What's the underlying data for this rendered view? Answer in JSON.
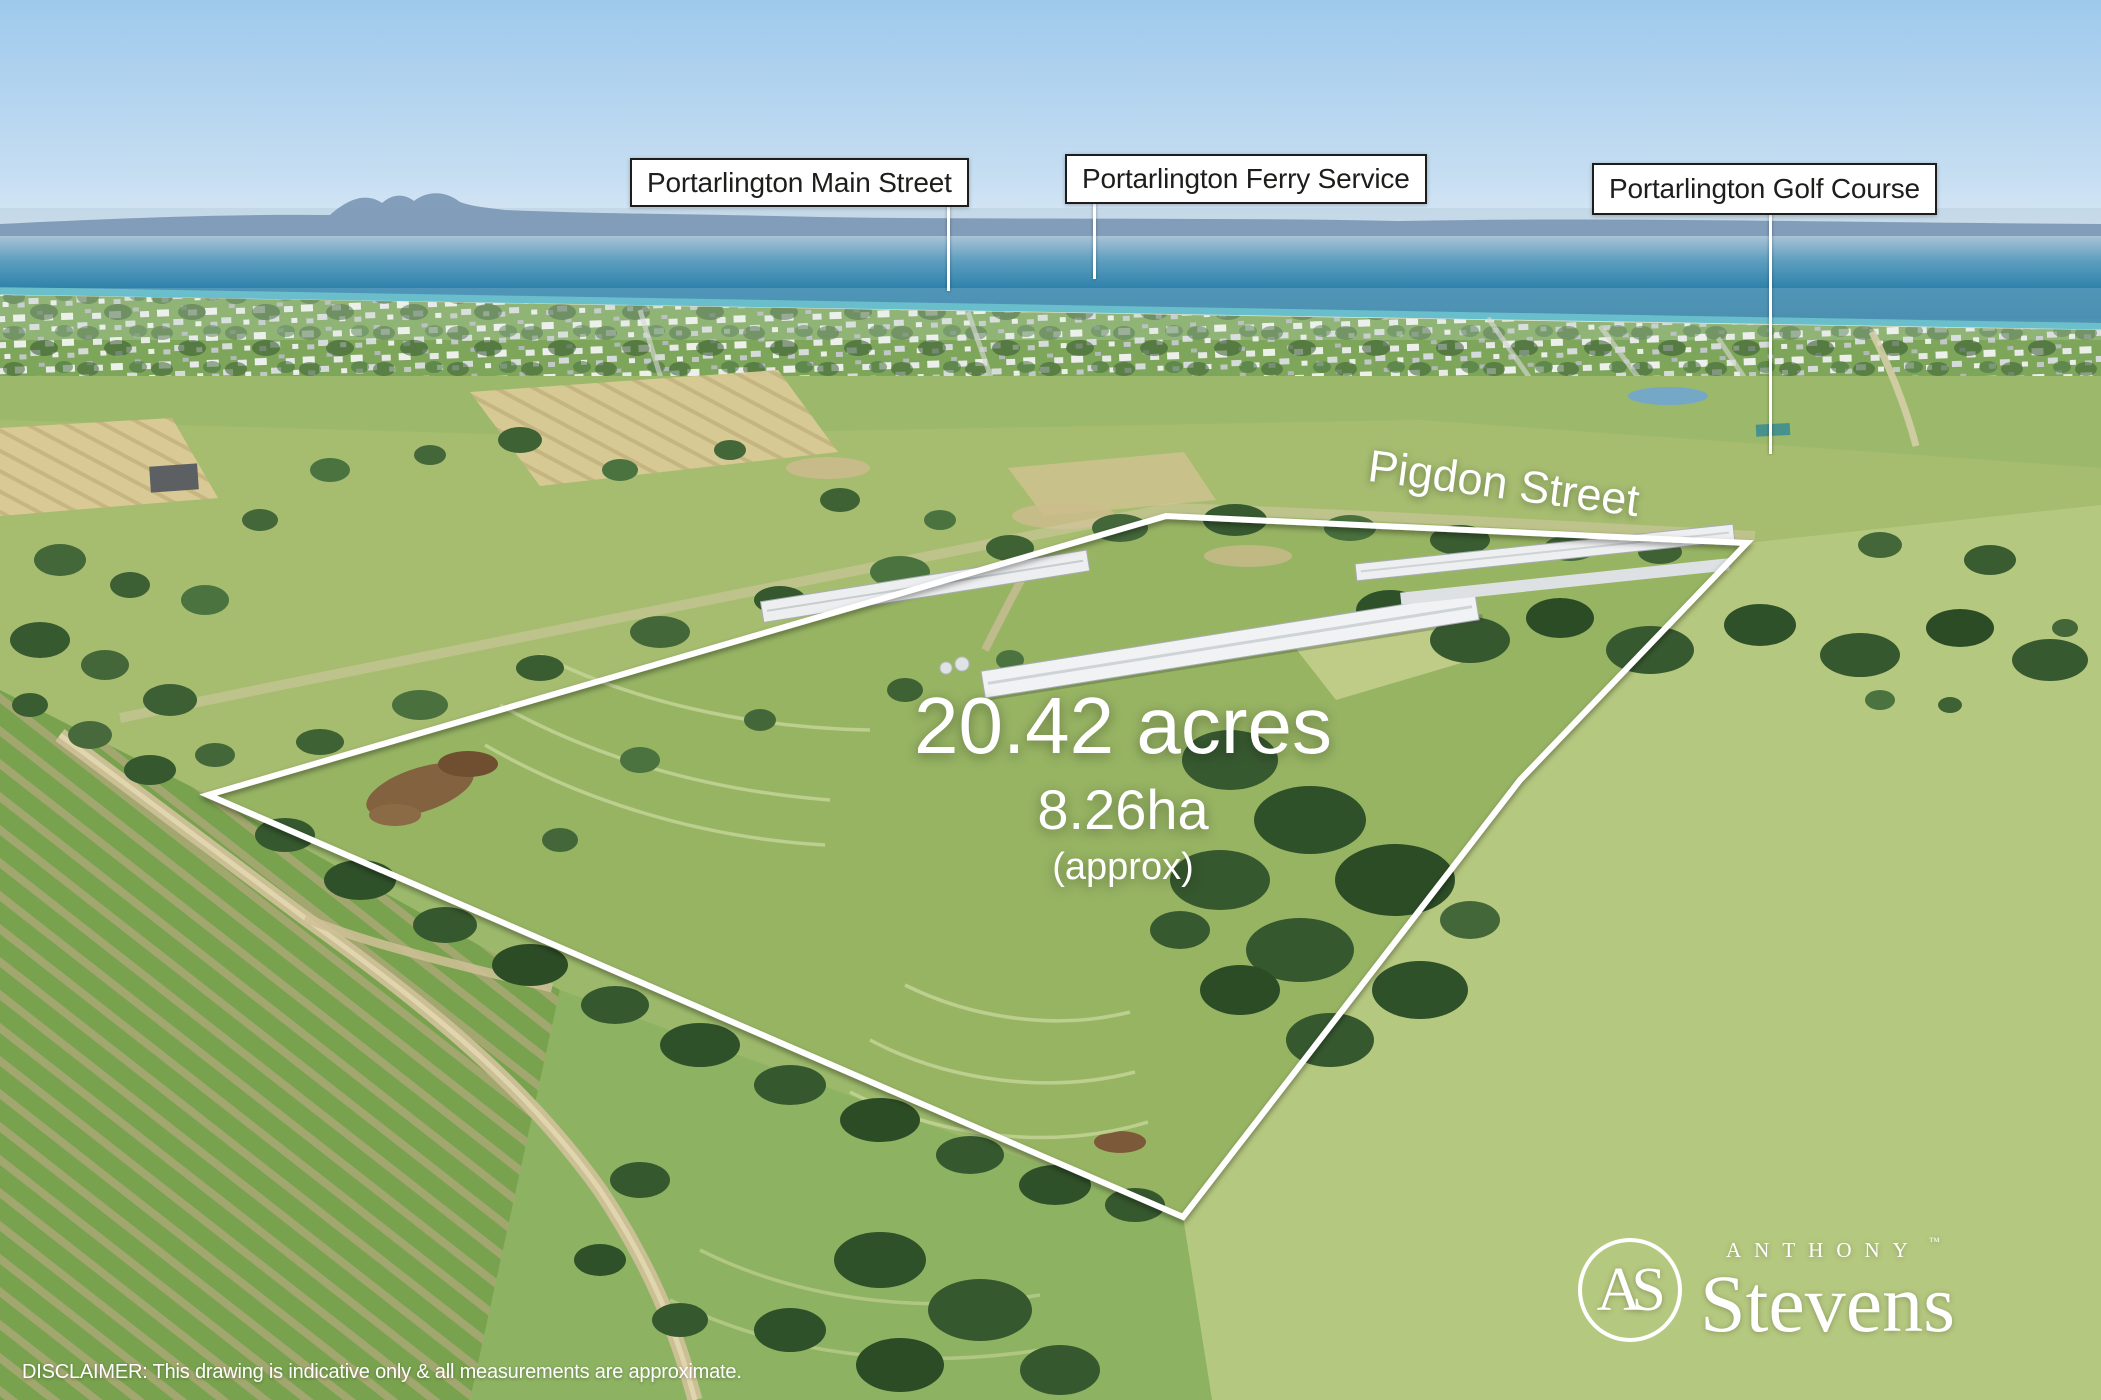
{
  "annotations": {
    "location_labels": [
      {
        "text": "Portarlington Main Street"
      },
      {
        "text": "Portarlington Ferry Service"
      },
      {
        "text": "Portarlington Golf Course"
      }
    ],
    "street_name": "Pigdon Street",
    "area": {
      "acres": "20.42 acres",
      "hectares": "8.26ha",
      "qualifier": "(approx)"
    }
  },
  "branding": {
    "monogram": "AS",
    "name_top": "ANTHONY",
    "name_bottom": "Stevens",
    "trademark": "™"
  },
  "disclaimer": "DISCLAIMER: This drawing is indicative only & all measurements are approximate.",
  "colors": {
    "boundary_line": "#ffffff",
    "label_background": "#ffffff",
    "label_border": "#1d1d1b",
    "label_text": "#1d1d1b",
    "overlay_text": "#ffffff",
    "sky": "#a7cfee",
    "sea_deep": "#2b7ba6",
    "sea_shore": "#58c0c9",
    "field_green": "#9cb96b"
  }
}
